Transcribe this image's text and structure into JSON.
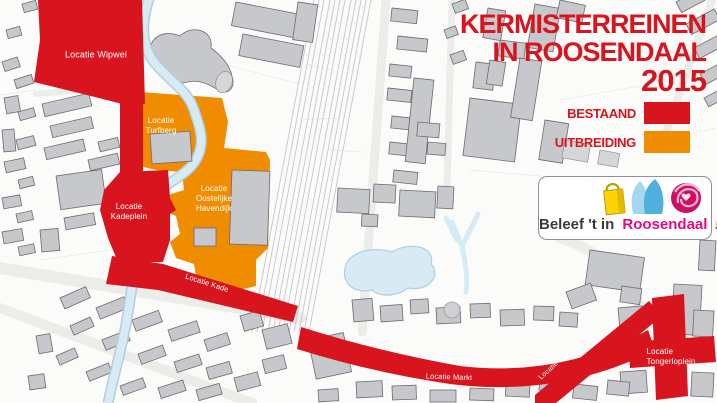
{
  "title": {
    "line1": "KERMISTERREINEN",
    "line2": "IN ROOSENDAAL",
    "line3": "2015"
  },
  "legend": {
    "items": [
      {
        "label": "BESTAAND",
        "meaning": "existing",
        "color": "#d8141e"
      },
      {
        "label": "UITBREIDING",
        "meaning": "expansion",
        "color": "#f08c00"
      }
    ]
  },
  "logo": {
    "prefix": "Beleef 't in",
    "brand": "Roosendaal",
    "exclaim": "!",
    "icons": [
      "shopping-bag-icon",
      "blue-figures-icon",
      "rose-icon"
    ]
  },
  "map_labels": {
    "wipwei": {
      "text": "Locatie Wipwei"
    },
    "turfberg": {
      "line1": "Locatie",
      "line2": "Turfberg"
    },
    "havendijk": {
      "line1": "Locatie",
      "line2": "Oostelijke",
      "line3": "Havendijk"
    },
    "kadeplein": {
      "line1": "Locatie",
      "line2": "Kadeplein"
    },
    "kade": {
      "text": "Locatie Kade"
    },
    "markt": {
      "text": "Locatie Markt"
    },
    "bloemenmarkt": {
      "text": "Locatie Bloemenmarkt"
    },
    "tongerloplein": {
      "line1": "Locatie",
      "line2": "Tongerloplein"
    }
  },
  "colors": {
    "red": "#d8141e",
    "orange": "#f08c00",
    "water": "#d8ebf4",
    "water_edge": "#aecfdf",
    "building": "#c7c8cb",
    "building_edge": "#6b6b72",
    "brand_pink": "#e5097f",
    "brand_dark": "#3a3a39",
    "brand_exclaim": "#e94e1b",
    "bag_yellow": "#fcd303",
    "figure_blue": "#4fb0dd",
    "figure_blue_light": "#a5d8ee",
    "rose_pink": "#cd0e63"
  }
}
